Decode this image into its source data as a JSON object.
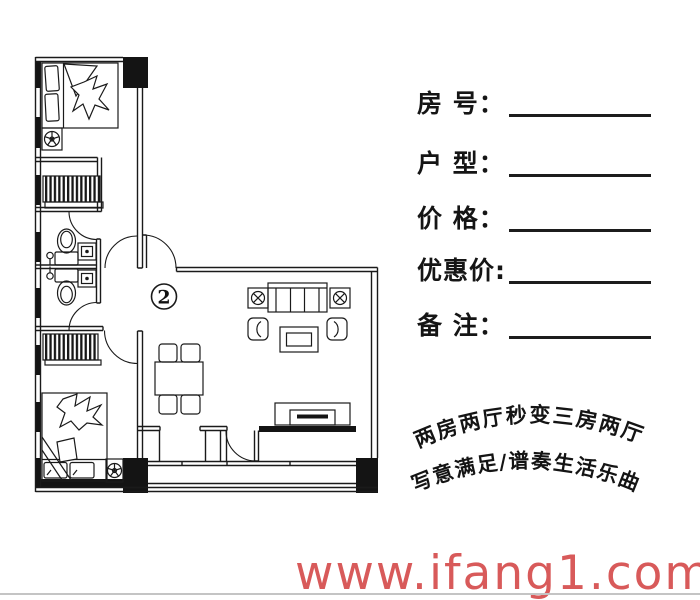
{
  "page": {
    "background_color": "#ffffff",
    "edge_line_color": "#c4c4c4"
  },
  "floor_plan": {
    "unit_label": "2",
    "line_color": "#1a1a1a",
    "rooms": [
      "top-bedroom",
      "bathroom-1",
      "bathroom-2",
      "bottom-bedroom",
      "living-dining-room",
      "balcony"
    ],
    "furniture": [
      "double-bed",
      "pillows",
      "quilt",
      "hatched-wardrobe",
      "toilet",
      "wash-basin",
      "shower-head",
      "potted-plant",
      "dining-table-with-4-chairs",
      "three-seat-sofa",
      "floor-lamp",
      "armchair",
      "coffee-table",
      "tv-cabinet",
      "entry-double-door",
      "structural-columns"
    ]
  },
  "form": {
    "rows": [
      {
        "label": "房 号："
      },
      {
        "label": "户 型："
      },
      {
        "label": "价 格："
      },
      {
        "label": "优惠价:"
      },
      {
        "label": "备 注："
      }
    ],
    "line_color": "#1c1c1c"
  },
  "slogan": {
    "line1": "两房两厅秒变三房两厅",
    "line2": "写意满足/谱奏生活乐曲",
    "color": "#141414"
  },
  "watermark": {
    "text": "www.ifang1.com",
    "color": "#d85a5a"
  }
}
